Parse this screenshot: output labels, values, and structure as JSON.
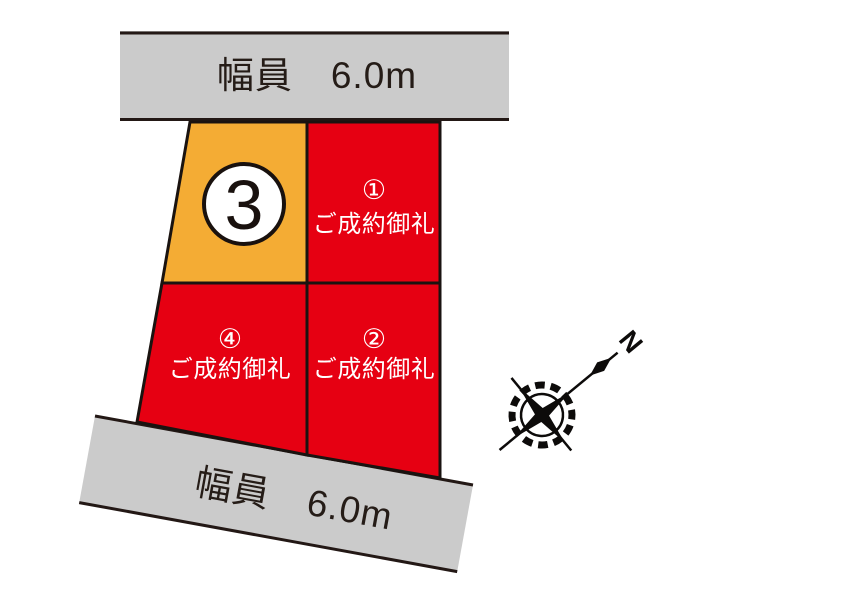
{
  "page": {
    "background": "#FFFFFF",
    "outline_color": "#1A1310"
  },
  "roads": {
    "top": {
      "label": "幅員　6.0m",
      "fill": "#CBCBCB"
    },
    "bottom": {
      "label": "幅員　6.0m",
      "fill": "#CBCBCB"
    }
  },
  "lots": [
    {
      "id": "3",
      "number": "3",
      "fill": "#F4AC34"
    },
    {
      "id": "1",
      "badge": "①",
      "status": "ご成約御礼",
      "fill": "#E60012"
    },
    {
      "id": "2",
      "badge": "②",
      "status": "ご成約御礼",
      "fill": "#E60012"
    },
    {
      "id": "4",
      "badge": "④",
      "status": "ご成約御礼",
      "fill": "#E60012"
    }
  ],
  "compass": {
    "north_label": "N"
  }
}
